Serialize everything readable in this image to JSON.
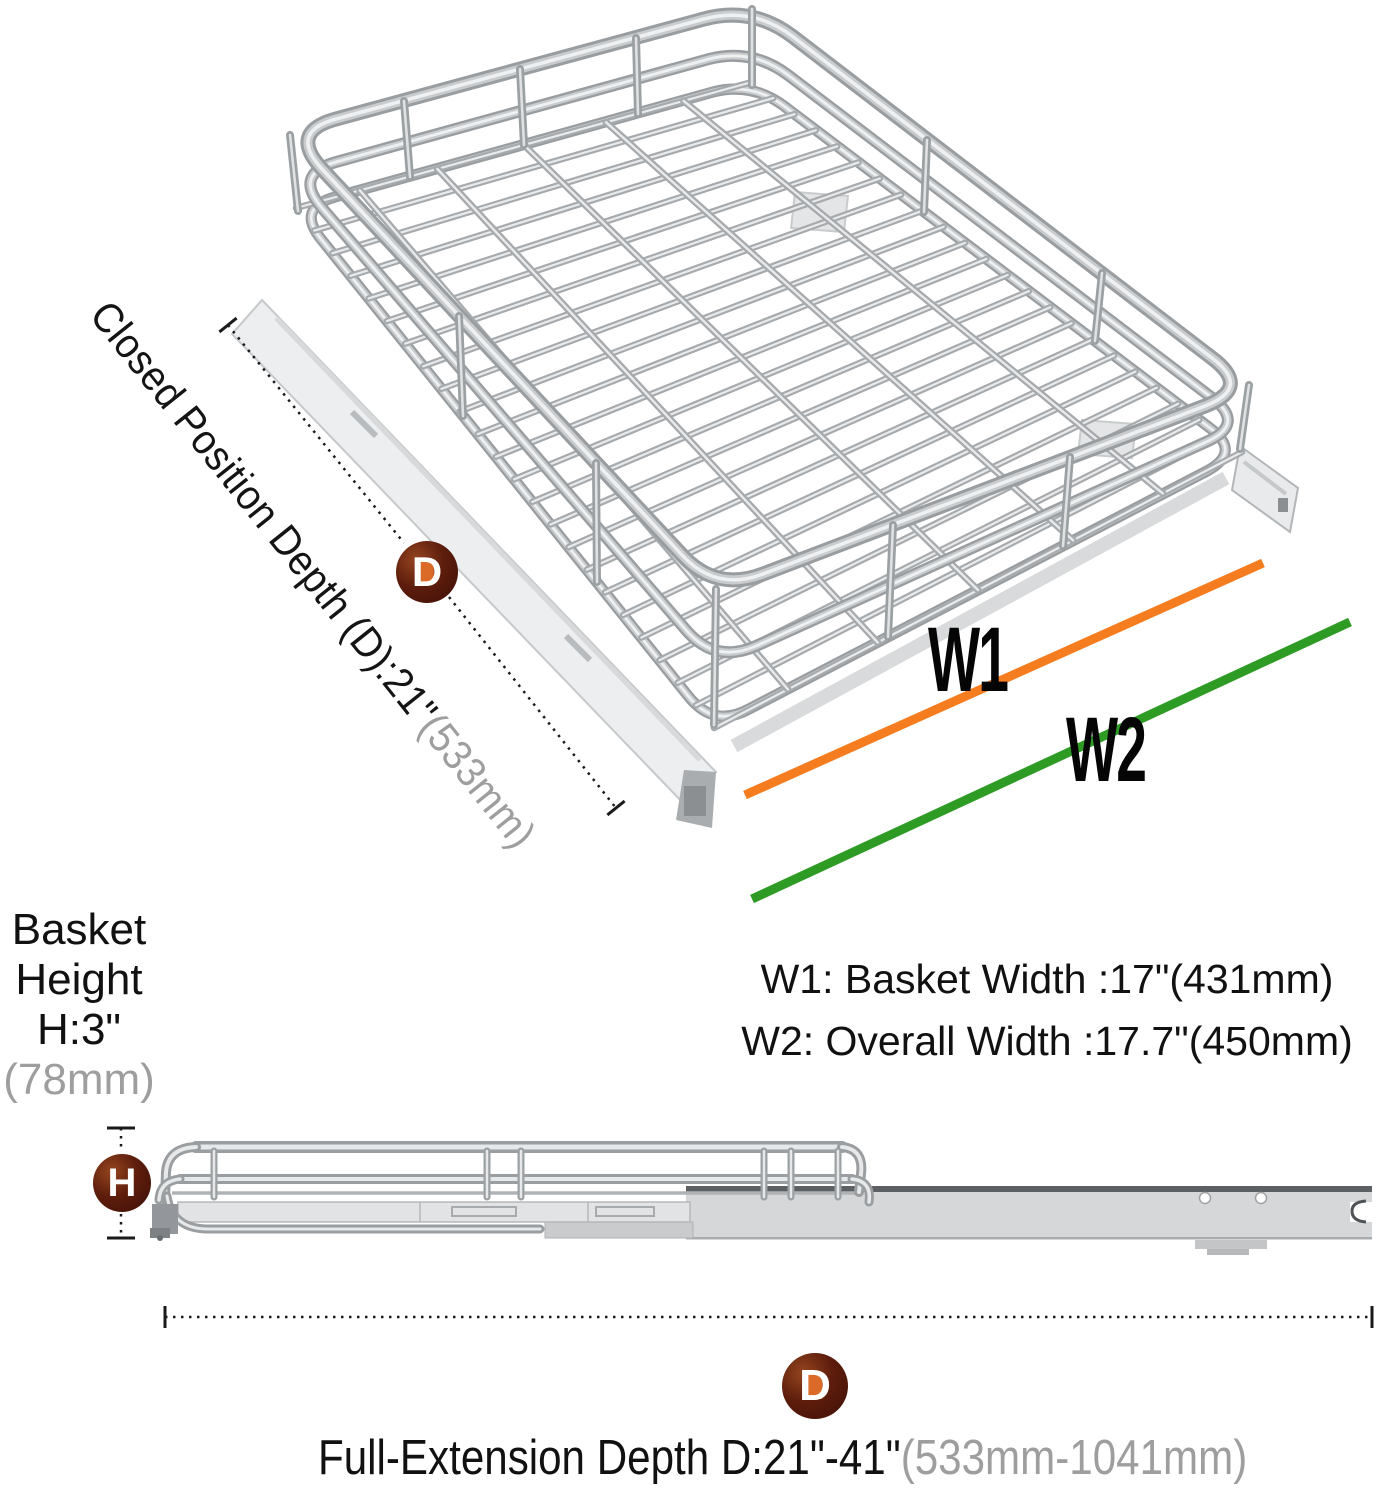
{
  "depth": {
    "badge": "D",
    "label": "Closed Position Depth (D):21\"",
    "metric": "(533mm)"
  },
  "width_info": {
    "w1_tag": "W1",
    "w2_tag": "W2",
    "w1_desc": "W1: Basket Width :17\"(431mm)",
    "w2_desc": "W2: Overall Width :17.7\"(450mm)"
  },
  "height_info": {
    "badge": "H",
    "word1": "Basket",
    "word2": "Height",
    "value": "H:3\"",
    "metric": "(78mm)"
  },
  "extension": {
    "badge": "D",
    "label": "Full-Extension Depth D:21\"-41\"",
    "metric": "(533mm-1041mm)"
  },
  "colors": {
    "w1_line_orange": "#f57d1f",
    "w2_line_green": "#2e9b24",
    "muted_text": "#9e9e9e",
    "badge_maroon": "#5e1d0c"
  }
}
